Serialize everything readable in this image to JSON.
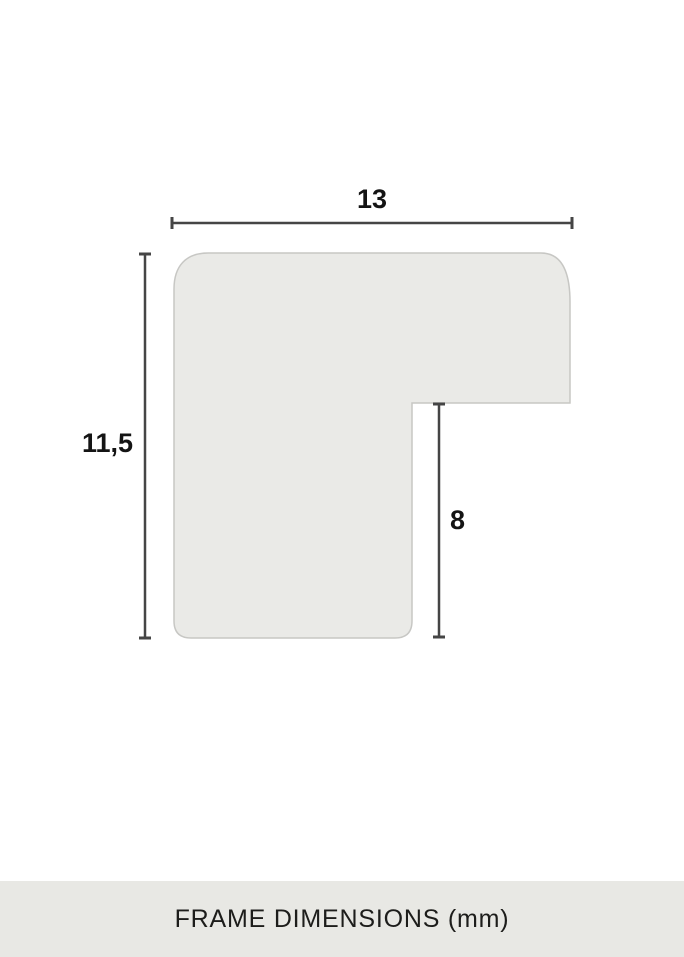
{
  "diagram": {
    "title": "frame-moulding-cross-section",
    "dimensions": [
      {
        "id": "width",
        "value": "13",
        "orientation": "horizontal",
        "measures": "total moulding width"
      },
      {
        "id": "height",
        "value": "11,5",
        "orientation": "vertical",
        "measures": "total moulding height"
      },
      {
        "id": "rabbet",
        "value": "8",
        "orientation": "vertical",
        "measures": "rabbet depth"
      }
    ],
    "unit": "mm"
  },
  "footer": {
    "caption": "FRAME DIMENSIONS (mm)"
  },
  "colors": {
    "background": "#ffffff",
    "shape_fill": "#eaeae7",
    "shape_stroke": "#c7c7c4",
    "dimension_line": "#454545",
    "label_text": "#141414",
    "footer_bar": "#e8e8e4",
    "footer_text": "#1d1d1b"
  }
}
